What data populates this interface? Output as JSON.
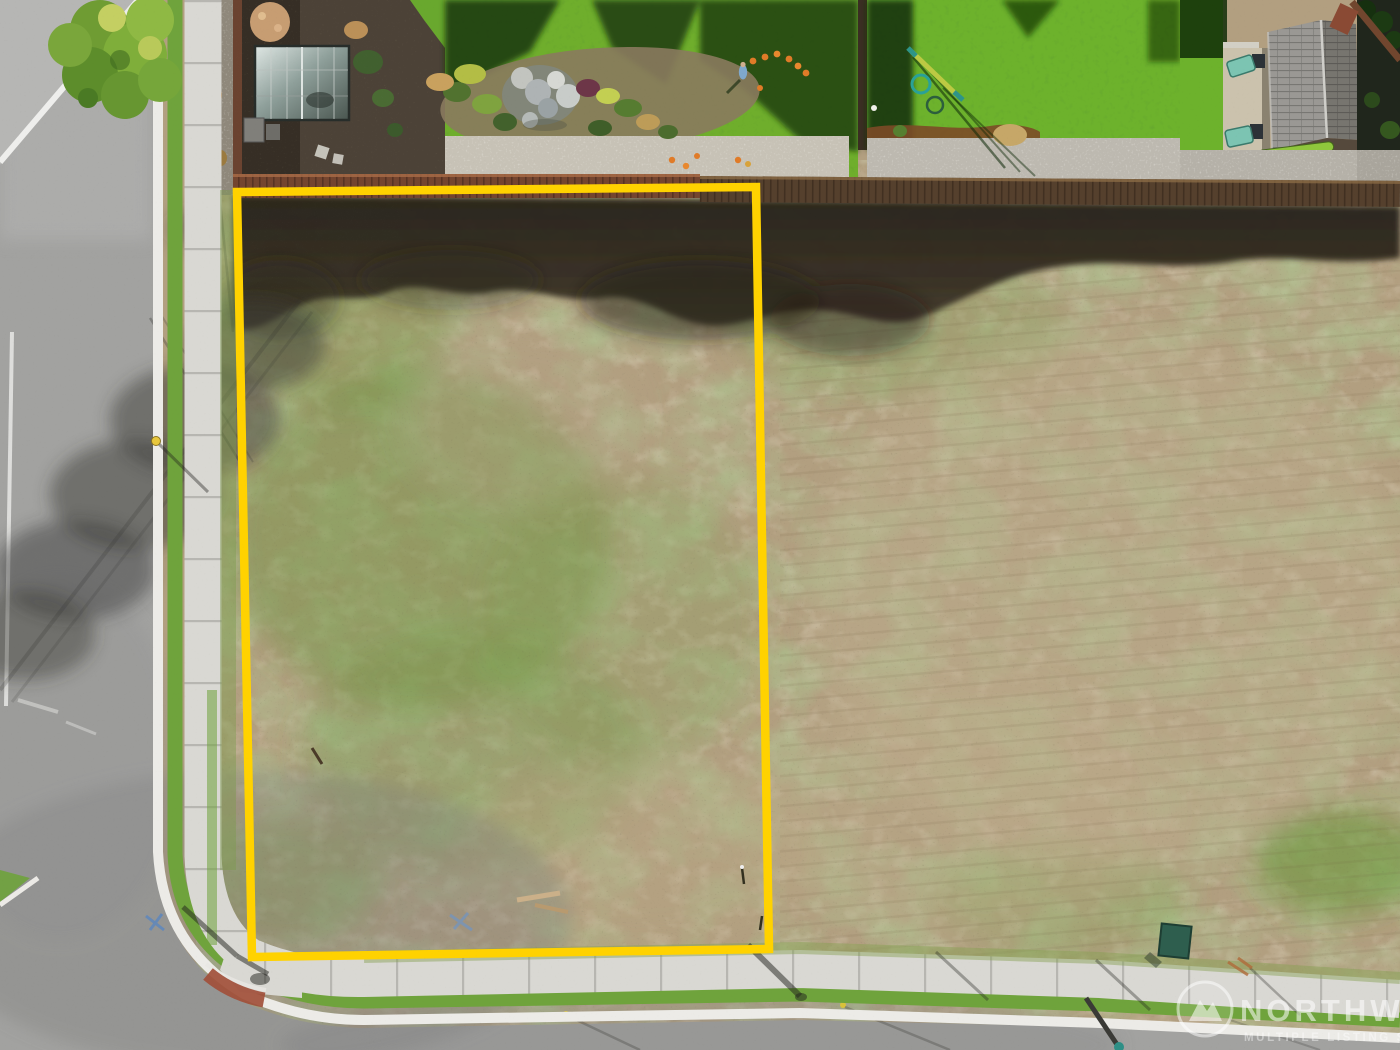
{
  "scene": {
    "description": "Aerial drone photo of a vacant corner lot outlined in yellow, bordered by a street on the left and bottom, with fenced landscaped backyards along the top",
    "boundary_color": "#ffd200",
    "ground_color": "#b29f80",
    "grass_color": "#6fa33c",
    "road_color": "#a2a2a0",
    "sidewalk_color": "#d9d8d3"
  },
  "watermark": {
    "brand": "NORTHWEST",
    "tagline": "MULTIPLE LISTING SERVICE",
    "logo": "nwmls-mountain-logo"
  }
}
